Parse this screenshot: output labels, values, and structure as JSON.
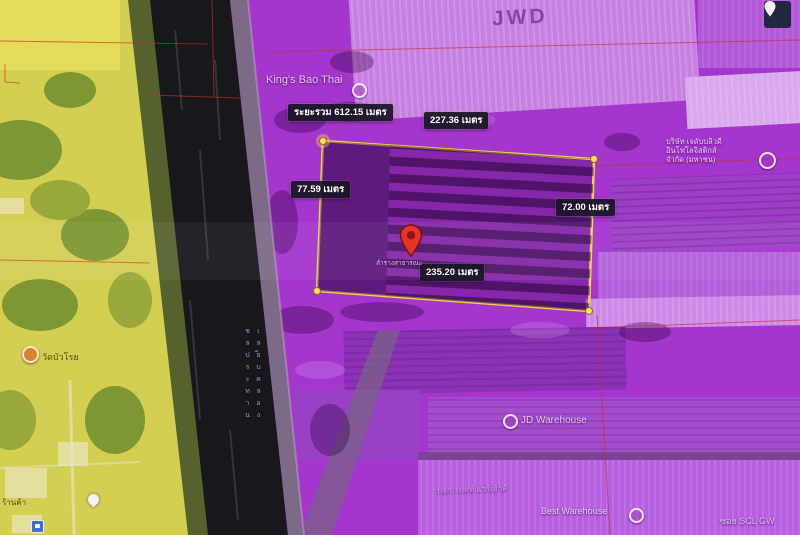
{
  "window": {
    "width": 800,
    "height": 535
  },
  "map": {
    "type": "satellite-with-zoning-overlay",
    "plot": {
      "measurements": {
        "total": "ระยะรวม 612.15 เมตร",
        "side_top": "227.36 เมตร",
        "side_left": "77.59 เมตร",
        "side_right": "72.00 เมตร",
        "side_bottom": "235.20 เมตร"
      },
      "pin_caption": "ลำรางสาธารณะ"
    },
    "place_labels": {
      "jwd_roof": "JWD",
      "kings_bao": "King's Bao Thai",
      "company": [
        "บริษัท เจดับบลิวดี",
        "อินโฟโลจิสติกส์",
        "จำกัด (มหาชน)"
      ],
      "jd_warehouse": "JD Warehouse",
      "best_company": "บจก. เบสท์ แวร์เฮ้าส์",
      "best_warehouse": "Best Warehouse",
      "soi": "ซอย SCL GW",
      "temple": "วัดบัวโรย",
      "shop": "ร้านค้า",
      "road_along_canal": "เลียบคลองชลประทาน"
    }
  },
  "colors": {
    "chip_bg": "rgba(26,22,38,0.93)",
    "chip_text": "#ffffff",
    "label_text": "rgba(245,238,255,0.82)",
    "plot_outline": "#f2d24f",
    "vertex_fill": "#ffdf5e",
    "overlay_purple": "#a435cd",
    "zone_yellow": "#d3cf52",
    "canal_dark": "#17171c",
    "red_line": "#c62f2f",
    "pin_red": "#e5352b",
    "button_bg": "#222742"
  }
}
